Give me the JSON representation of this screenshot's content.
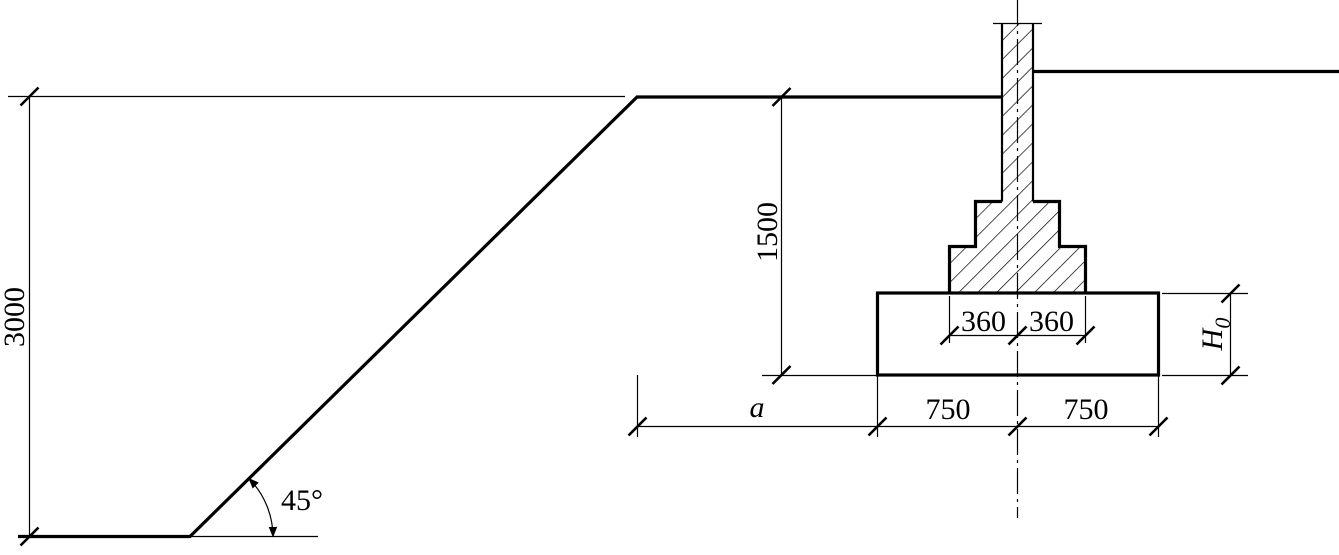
{
  "colors": {
    "line": "#000000",
    "background": "#ffffff"
  },
  "labels": {
    "excavation_depth": "3000",
    "embedment_depth": "1500",
    "slope_angle": "45°",
    "pedestal_left": "360",
    "pedestal_right": "360",
    "offset_a": "a",
    "footing_left": "750",
    "footing_right": "750",
    "footing_height_symbol": "H",
    "footing_height_subscript": "0"
  }
}
